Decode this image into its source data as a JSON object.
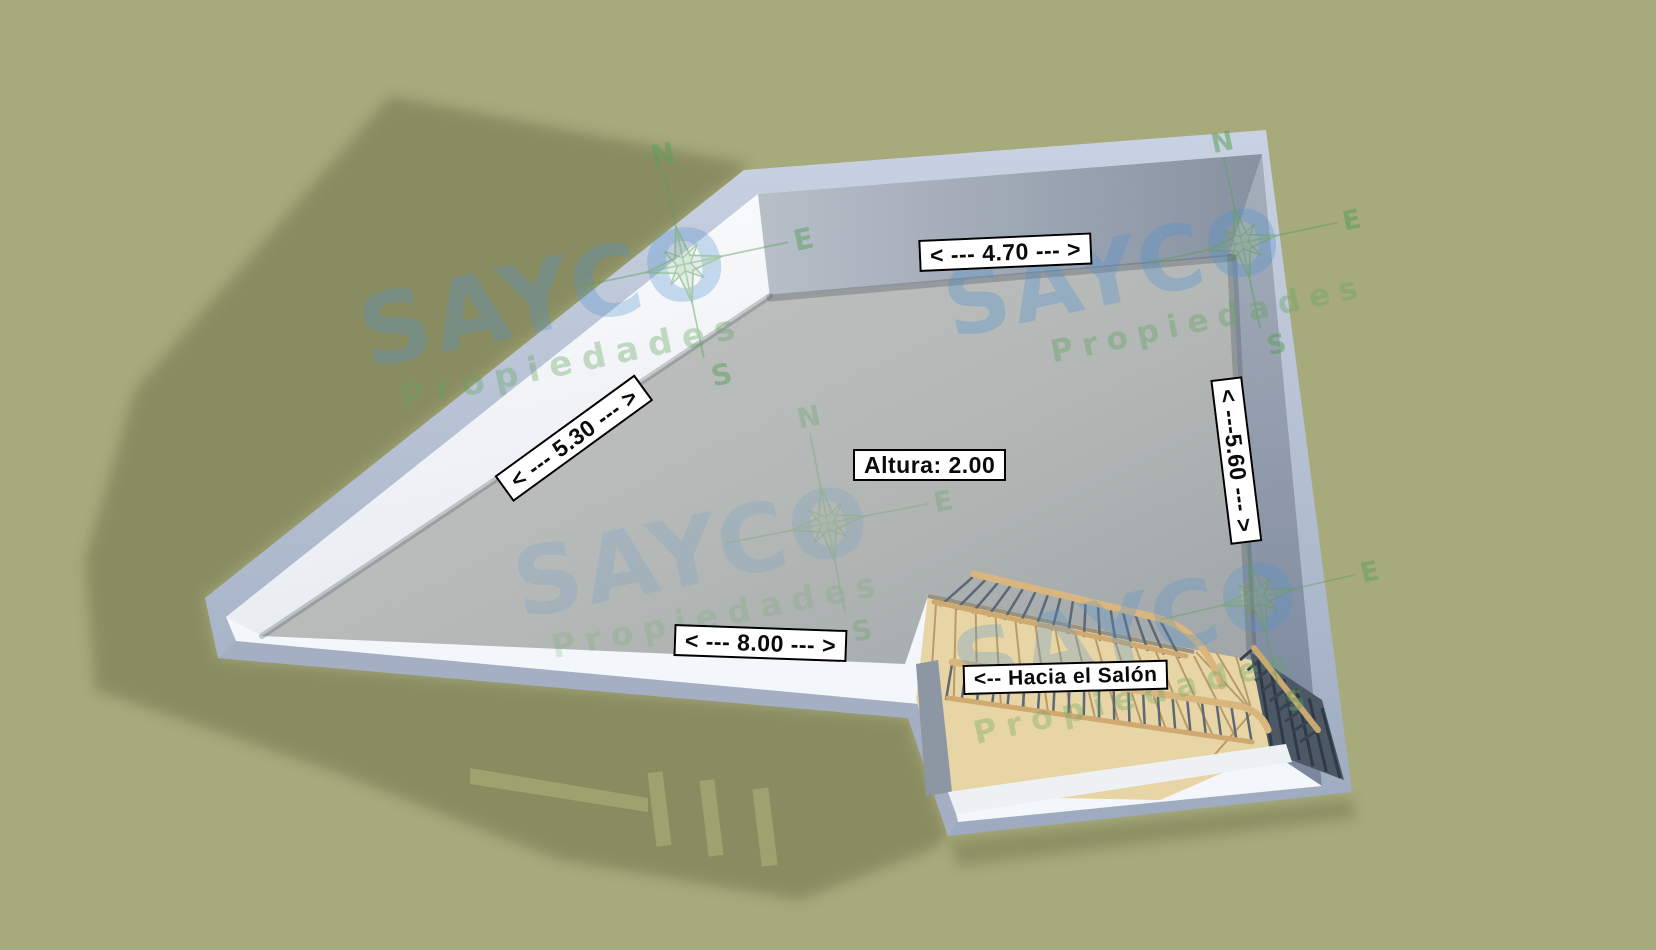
{
  "dimension_labels": {
    "top_wall": "< --- 4.70 --- >",
    "diagonal_wall": "< --- 5.30 --- >",
    "right_wall": "< ---5.60 --- >",
    "bottom_wall": "< --- 8.00 --- >"
  },
  "height_label": "Altura: 2.00",
  "stairs_label": "<-- Hacia el Salón",
  "watermark": {
    "brand": "SAYCO",
    "tagline": "Propiedades",
    "compass": {
      "north": "N",
      "east": "E",
      "south": "S"
    }
  },
  "colors": {
    "background": "#a7aa7b",
    "shadow": "#868a5f",
    "wall_outer": "#bcc6d8",
    "wall_top": "#f3f6fa",
    "floor": "#b5b8b6",
    "stair_wood": "#e8d5a6",
    "baluster": "#5d6875",
    "watermark_blue": "#5a91c8",
    "watermark_green": "#64a45f",
    "label_bg": "#ffffff",
    "label_text": "#0a0a0a"
  }
}
